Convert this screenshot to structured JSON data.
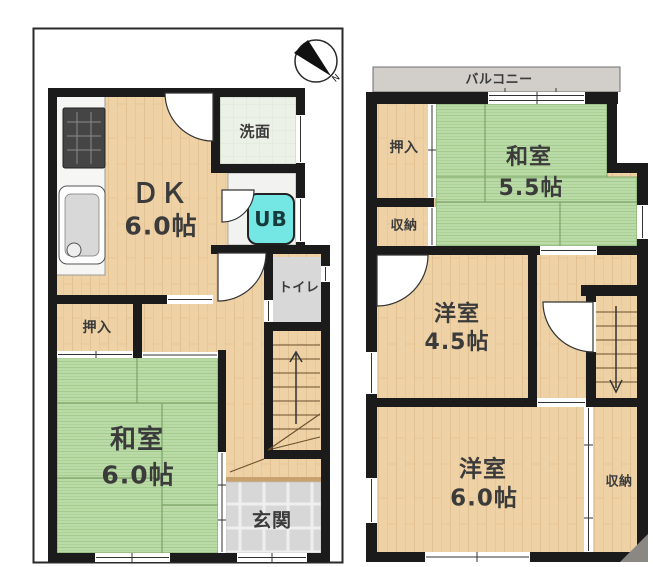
{
  "compass": {
    "label": "N"
  },
  "colors": {
    "wall": "#1b1b1b",
    "wood": "#eed2a5",
    "tatami": "#badaa7",
    "entrance_tile": "#d7d7d7",
    "balcony_gray": "#d2cfca",
    "washroom_pale": "#ecf1e8",
    "unit_bath_cyan": "#74e6e3",
    "label_text": "#3b3b3b"
  },
  "floor1": {
    "rooms": {
      "dk": {
        "label": "ＤＫ",
        "size": "6.0帖"
      },
      "washroom": {
        "label": "洗面"
      },
      "unit_bath": {
        "label": "UB"
      },
      "toilet": {
        "label": "トイレ"
      },
      "closet": {
        "label": "押入"
      },
      "washitsu": {
        "label": "和室",
        "size": "6.0帖"
      },
      "entrance": {
        "label": "玄関"
      }
    }
  },
  "floor2": {
    "rooms": {
      "balcony": {
        "label": "バルコニー"
      },
      "closet": {
        "label": "押入"
      },
      "washitsu": {
        "label": "和室",
        "size": "5.5帖"
      },
      "storage_left": {
        "label": "収納"
      },
      "western_45": {
        "label": "洋室",
        "size": "4.5帖"
      },
      "western_60": {
        "label": "洋室",
        "size": "6.0帖"
      },
      "storage_right": {
        "label": "収納"
      }
    }
  }
}
